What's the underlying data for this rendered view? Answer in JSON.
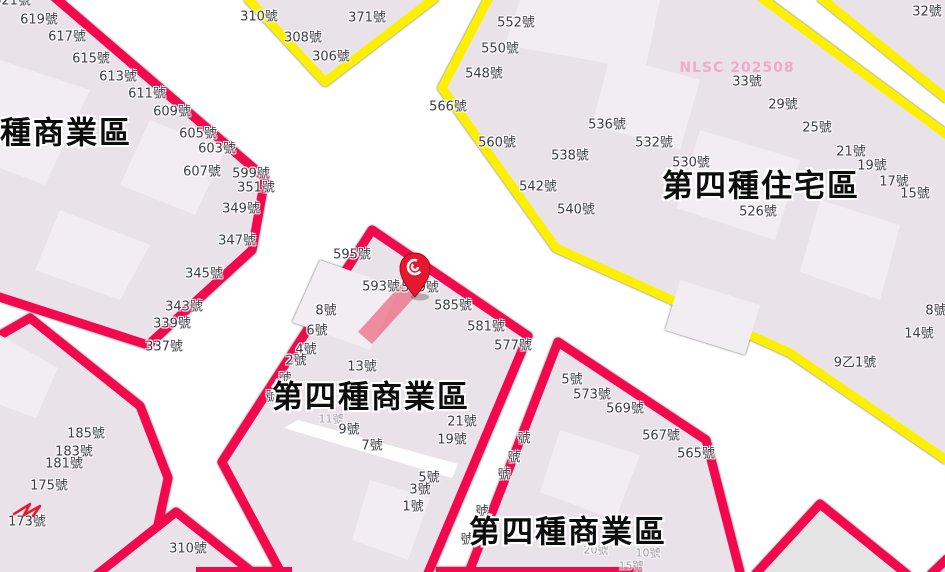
{
  "map": {
    "type": "land-use-zoning-map",
    "watermark": {
      "text": "NLSC 202508",
      "x": 737,
      "y": 68
    },
    "colors": {
      "commercial_border": "#f3074d",
      "residential_border": "#fcf000",
      "parcel_fill": "#e9e2e8",
      "building_fill": "#f2edf2",
      "road": "#ffffff",
      "outside_fill": "#e4e4e4",
      "text": "#3c3c44",
      "title_text": "#0d0d0d",
      "watermark": "#f2a6c6",
      "pin": "#e6172f",
      "highlight": "rgba(236,62,92,0.55)"
    },
    "zone_titles": [
      {
        "text": "第四種商業區",
        "x": 33,
        "y": 134
      },
      {
        "text": "第四種住宅區",
        "x": 761,
        "y": 187
      },
      {
        "text": "第四種商業區",
        "x": 371,
        "y": 398
      },
      {
        "text": "第四種商業區",
        "x": 568,
        "y": 533
      }
    ],
    "marker": {
      "name": "location-pin",
      "x": 415,
      "y": 268
    },
    "highlight_parcel": {
      "points": "405,280 419,292 372,344 358,332"
    },
    "labels": [
      {
        "t": "621號",
        "x": 12,
        "y": 1,
        "k": "n"
      },
      {
        "t": "619號",
        "x": 39,
        "y": 20,
        "k": "n"
      },
      {
        "t": "617號",
        "x": 67,
        "y": 37,
        "k": "n"
      },
      {
        "t": "615號",
        "x": 91,
        "y": 59,
        "k": "n"
      },
      {
        "t": "613號",
        "x": 118,
        "y": 77,
        "k": "n"
      },
      {
        "t": "611號",
        "x": 147,
        "y": 94,
        "k": "n"
      },
      {
        "t": "609號",
        "x": 172,
        "y": 112,
        "k": "n"
      },
      {
        "t": "605號",
        "x": 198,
        "y": 134,
        "k": "n"
      },
      {
        "t": "603號",
        "x": 217,
        "y": 149,
        "k": "n"
      },
      {
        "t": "607號",
        "x": 202,
        "y": 172,
        "k": "n"
      },
      {
        "t": "599號",
        "x": 251,
        "y": 174,
        "k": "n"
      },
      {
        "t": "351號",
        "x": 256,
        "y": 188,
        "k": "n"
      },
      {
        "t": "349號",
        "x": 241,
        "y": 209,
        "k": "n"
      },
      {
        "t": "347號",
        "x": 237,
        "y": 241,
        "k": "n"
      },
      {
        "t": "345號",
        "x": 204,
        "y": 274,
        "k": "n"
      },
      {
        "t": "343號",
        "x": 184,
        "y": 307,
        "k": "n"
      },
      {
        "t": "339號",
        "x": 172,
        "y": 324,
        "k": "n"
      },
      {
        "t": "337號",
        "x": 164,
        "y": 347,
        "k": "n"
      },
      {
        "t": "310號",
        "x": 259,
        "y": 17,
        "k": "n"
      },
      {
        "t": "371號",
        "x": 367,
        "y": 18,
        "k": "n"
      },
      {
        "t": "308號",
        "x": 303,
        "y": 38,
        "k": "n"
      },
      {
        "t": "306號",
        "x": 331,
        "y": 57,
        "k": "n"
      },
      {
        "t": "552號",
        "x": 516,
        "y": 23,
        "k": "n"
      },
      {
        "t": "550號",
        "x": 500,
        "y": 49,
        "k": "n"
      },
      {
        "t": "548號",
        "x": 484,
        "y": 74,
        "k": "n"
      },
      {
        "t": "566號",
        "x": 448,
        "y": 107,
        "k": "n"
      },
      {
        "t": "560號",
        "x": 497,
        "y": 143,
        "k": "n"
      },
      {
        "t": "536號",
        "x": 607,
        "y": 125,
        "k": "n"
      },
      {
        "t": "538號",
        "x": 570,
        "y": 156,
        "k": "n"
      },
      {
        "t": "532號",
        "x": 654,
        "y": 143,
        "k": "n"
      },
      {
        "t": "530號",
        "x": 691,
        "y": 163,
        "k": "n"
      },
      {
        "t": "542號",
        "x": 538,
        "y": 187,
        "k": "n"
      },
      {
        "t": "540號",
        "x": 576,
        "y": 210,
        "k": "n"
      },
      {
        "t": "526號",
        "x": 758,
        "y": 212,
        "k": "n"
      },
      {
        "t": "33號",
        "x": 747,
        "y": 82,
        "k": "n"
      },
      {
        "t": "29號",
        "x": 783,
        "y": 105,
        "k": "n"
      },
      {
        "t": "25號",
        "x": 817,
        "y": 128,
        "k": "n"
      },
      {
        "t": "21號",
        "x": 851,
        "y": 152,
        "k": "n"
      },
      {
        "t": "19號",
        "x": 872,
        "y": 166,
        "k": "n"
      },
      {
        "t": "17號",
        "x": 894,
        "y": 182,
        "k": "n"
      },
      {
        "t": "15號",
        "x": 915,
        "y": 194,
        "k": "n"
      },
      {
        "t": "32號",
        "x": 927,
        "y": 12,
        "k": "n"
      },
      {
        "t": "8號",
        "x": 936,
        "y": 311,
        "k": "n"
      },
      {
        "t": "14號",
        "x": 919,
        "y": 334,
        "k": "n"
      },
      {
        "t": "9乙1號",
        "x": 855,
        "y": 363,
        "k": "n"
      },
      {
        "t": "595號",
        "x": 352,
        "y": 255,
        "k": "n"
      },
      {
        "t": "593號",
        "x": 381,
        "y": 287,
        "k": "n"
      },
      {
        "t": "589號",
        "x": 420,
        "y": 288,
        "k": "n"
      },
      {
        "t": "585號",
        "x": 453,
        "y": 306,
        "k": "n"
      },
      {
        "t": "581號",
        "x": 486,
        "y": 327,
        "k": "n"
      },
      {
        "t": "577號",
        "x": 513,
        "y": 346,
        "k": "n"
      },
      {
        "t": "8號",
        "x": 326,
        "y": 311,
        "k": "n"
      },
      {
        "t": "6號",
        "x": 317,
        "y": 331,
        "k": "n"
      },
      {
        "t": "4號",
        "x": 306,
        "y": 350,
        "k": "n"
      },
      {
        "t": "2號",
        "x": 296,
        "y": 361,
        "k": "n"
      },
      {
        "t": "號",
        "x": 285,
        "y": 379,
        "k": "n"
      },
      {
        "t": "號",
        "x": 272,
        "y": 397,
        "k": "n"
      },
      {
        "t": "13號",
        "x": 362,
        "y": 367,
        "k": "n"
      },
      {
        "t": "11號",
        "x": 331,
        "y": 419,
        "k": "f"
      },
      {
        "t": "9號",
        "x": 349,
        "y": 430,
        "k": "n"
      },
      {
        "t": "7號",
        "x": 372,
        "y": 446,
        "k": "n"
      },
      {
        "t": "21號",
        "x": 462,
        "y": 422,
        "k": "n"
      },
      {
        "t": "19號",
        "x": 452,
        "y": 440,
        "k": "n"
      },
      {
        "t": "5號",
        "x": 429,
        "y": 478,
        "k": "n"
      },
      {
        "t": "3號",
        "x": 420,
        "y": 490,
        "k": "n"
      },
      {
        "t": "1號",
        "x": 413,
        "y": 507,
        "k": "n"
      },
      {
        "t": "號",
        "x": 524,
        "y": 439,
        "k": "n"
      },
      {
        "t": "號",
        "x": 514,
        "y": 458,
        "k": "n"
      },
      {
        "t": "號",
        "x": 504,
        "y": 475,
        "k": "n"
      },
      {
        "t": "號",
        "x": 482,
        "y": 512,
        "k": "n"
      },
      {
        "t": "號",
        "x": 467,
        "y": 540,
        "k": "n"
      },
      {
        "t": "5號",
        "x": 572,
        "y": 380,
        "k": "n"
      },
      {
        "t": "573號",
        "x": 592,
        "y": 395,
        "k": "n"
      },
      {
        "t": "569號",
        "x": 625,
        "y": 409,
        "k": "n"
      },
      {
        "t": "567號",
        "x": 661,
        "y": 436,
        "k": "n"
      },
      {
        "t": "565號",
        "x": 696,
        "y": 454,
        "k": "n"
      },
      {
        "t": "20號",
        "x": 596,
        "y": 550,
        "k": "f"
      },
      {
        "t": "10號",
        "x": 648,
        "y": 553,
        "k": "f"
      },
      {
        "t": "15號",
        "x": 631,
        "y": 566,
        "k": "f"
      },
      {
        "t": "185號",
        "x": 86,
        "y": 434,
        "k": "n"
      },
      {
        "t": "183號",
        "x": 74,
        "y": 452,
        "k": "n"
      },
      {
        "t": "181號",
        "x": 64,
        "y": 464,
        "k": "n"
      },
      {
        "t": "175號",
        "x": 49,
        "y": 486,
        "k": "n"
      },
      {
        "t": "173號",
        "x": 27,
        "y": 522,
        "k": "n"
      },
      {
        "t": "310號",
        "x": 188,
        "y": 549,
        "k": "n"
      }
    ]
  }
}
